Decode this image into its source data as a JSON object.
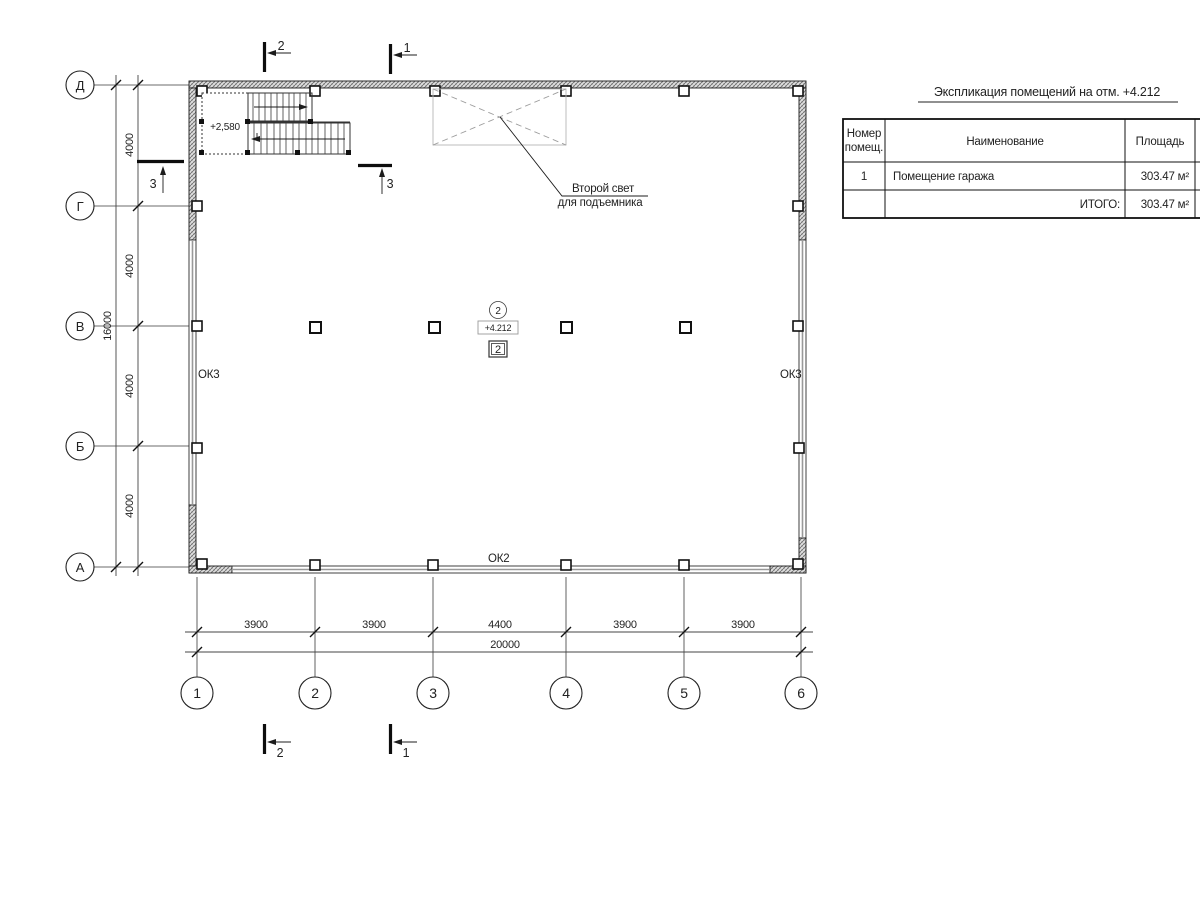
{
  "axes": {
    "rows": [
      "Д",
      "Г",
      "В",
      "Б",
      "А"
    ],
    "cols": [
      "1",
      "2",
      "3",
      "4",
      "5",
      "6"
    ]
  },
  "dims": {
    "left_segments": [
      "4000",
      "4000",
      "4000",
      "4000"
    ],
    "left_total": "16000",
    "bottom_segments": [
      "3900",
      "3900",
      "4400",
      "3900",
      "3900"
    ],
    "bottom_total": "20000"
  },
  "sections": {
    "top_left": "2",
    "top_right": "1",
    "bottom_left": "2",
    "bottom_right": "1",
    "side_left": "3",
    "side_right": "3"
  },
  "labels": {
    "stair_level": "+2,580",
    "void_line1": "Второй свет",
    "void_line2": "для подъемника",
    "detail_circle": "2",
    "level_mark": "+4.212",
    "node_mark": "2",
    "window_left": "ОК3",
    "window_right": "ОК3",
    "window_bottom": "ОК2"
  },
  "table": {
    "title": "Экспликация помещений на отм. +4.212",
    "header": {
      "col1_line1": "Номер",
      "col1_line2": "помещ.",
      "col2": "Наименование",
      "col3": "Площадь",
      "col4_line1": "К",
      "col4_line2": "п"
    },
    "rows": [
      {
        "num": "1",
        "name": "Помещение гаража",
        "area": "303.47 м²"
      }
    ],
    "total_label": "ИТОГО:",
    "total_area": "303.47 м²"
  }
}
